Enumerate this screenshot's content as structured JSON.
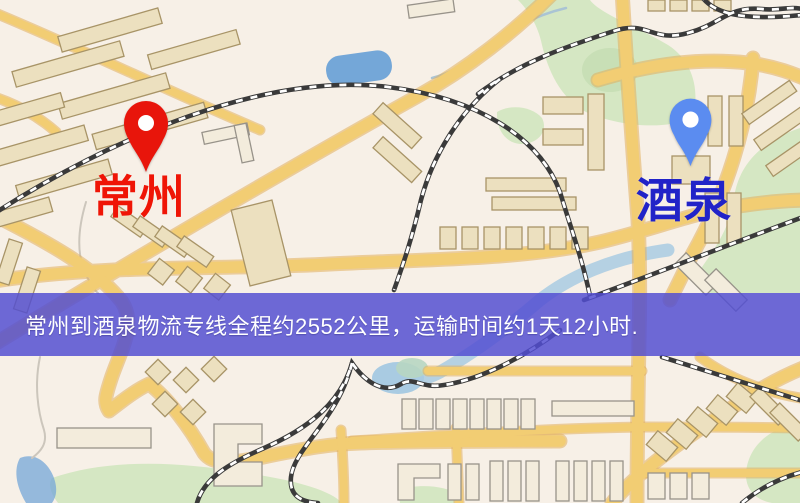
{
  "map": {
    "markers": [
      {
        "id": "origin",
        "label": "常州",
        "pin_color": "#e8150b",
        "label_color": "#ef1506"
      },
      {
        "id": "destination",
        "label": "酒泉",
        "pin_color": "#5b8cf0",
        "label_color": "#2123c8"
      }
    ],
    "banner": {
      "text": "常州到酒泉物流专线全程约2552公里，运输时间约1天12小时.",
      "bg_color": "#524ed2",
      "text_color": "#ffffff"
    },
    "palette": {
      "background": "#f7f0e7",
      "road": "#f2cd73",
      "road_border": "#e2b05c",
      "building_fill": "#ece0bf",
      "building_stroke": "#a89467",
      "building_light": "#f3ecdc",
      "building_light_stroke": "#98938a",
      "park": "#d5e7c3",
      "park_dark": "#c2dcb0",
      "water": "#74a7d8",
      "water_light": "#a9cbe2",
      "railway": "#3a3a3a"
    }
  }
}
